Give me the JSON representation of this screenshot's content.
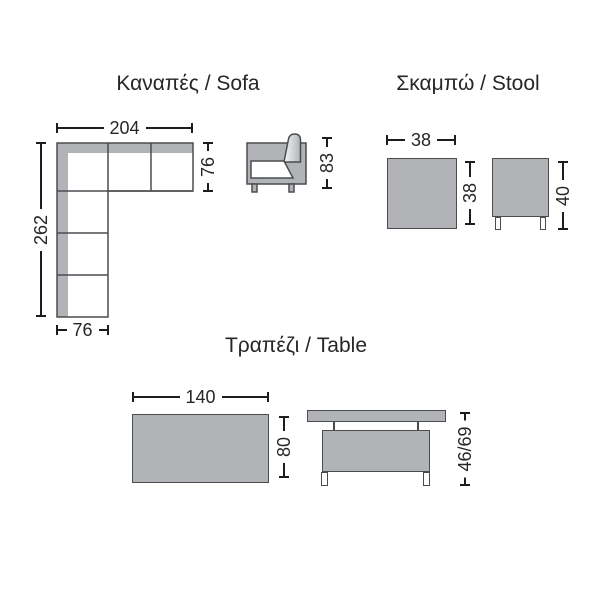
{
  "page": {
    "background": "#ffffff"
  },
  "colors": {
    "background": "#ffffff",
    "shape_fill": "#b1b3b6",
    "shape_outline": "#4a4d50",
    "seat_fill": "#ffffff",
    "dimension_line": "#1d1d1f",
    "text": "#262626"
  },
  "sofa": {
    "title": "Καναπές / Sofa",
    "dimensions": {
      "total_width": "204",
      "total_depth": "262",
      "arm_depth": "76",
      "bottom_width": "76",
      "side_height": "83"
    }
  },
  "stool": {
    "title": "Σκαμπώ / Stool",
    "dimensions": {
      "top_width": "38",
      "top_depth": "38",
      "side_height": "40"
    }
  },
  "table": {
    "title": "Τραπέζι / Table",
    "dimensions": {
      "top_width": "140",
      "top_depth": "80",
      "side_height": "46/69"
    }
  }
}
